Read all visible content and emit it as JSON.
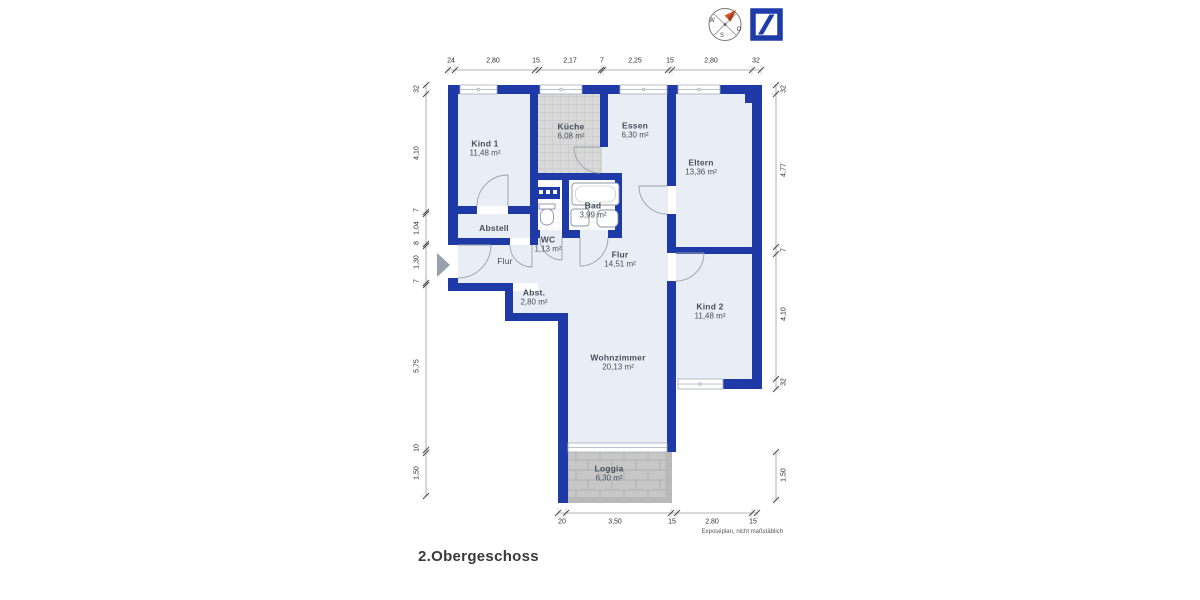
{
  "page": {
    "title": "2.Obergeschoss",
    "note": "Exposéplan, nicht maßstäblich"
  },
  "compass": {
    "w": "W",
    "o": "O",
    "s": "S"
  },
  "rooms": {
    "kind1": {
      "name": "Kind 1",
      "area": "11,48 m²"
    },
    "kueche": {
      "name": "Küche",
      "area": "6,08 m²"
    },
    "essen": {
      "name": "Essen",
      "area": "6,30 m²"
    },
    "eltern": {
      "name": "Eltern",
      "area": "13,36 m²"
    },
    "abstell": {
      "name": "Abstell"
    },
    "bad": {
      "name": "Bad",
      "area": "3,99 m²"
    },
    "wc": {
      "name": "WC",
      "area": "1,13 m²"
    },
    "flur_klein": {
      "name": "Flur"
    },
    "flur": {
      "name": "Flur",
      "area": "14,51 m²"
    },
    "abst": {
      "name": "Abst.",
      "area": "2,80 m²"
    },
    "kind2": {
      "name": "Kind 2",
      "area": "11,48 m²"
    },
    "wohnzimmer": {
      "name": "Wohnzimmer",
      "area": "20,13 m²"
    },
    "loggia": {
      "name": "Loggia",
      "area": "6,30 m²"
    }
  },
  "dims": {
    "top": [
      "24",
      "2,80",
      "15",
      "2,17",
      "7",
      "2,25",
      "15",
      "2,80",
      "32"
    ],
    "left": [
      "32",
      "4,10",
      "7",
      "1,04",
      "8",
      "1,30",
      "7",
      "5,75",
      "10",
      "1,50"
    ],
    "right": [
      "32",
      "4,77",
      "7",
      "4,10",
      "32"
    ],
    "right_loggia": [
      "1,50"
    ],
    "bottom": [
      "20",
      "3,50",
      "15",
      "2,80",
      "15"
    ]
  },
  "colors": {
    "wall": "#1d3aa6",
    "floor": "#e8edf6",
    "tile_kitchen": "#d8d8d8",
    "tile_loggia": "#c7c7c7",
    "accent": "#d4552a",
    "logo": "#1e3ca8"
  }
}
